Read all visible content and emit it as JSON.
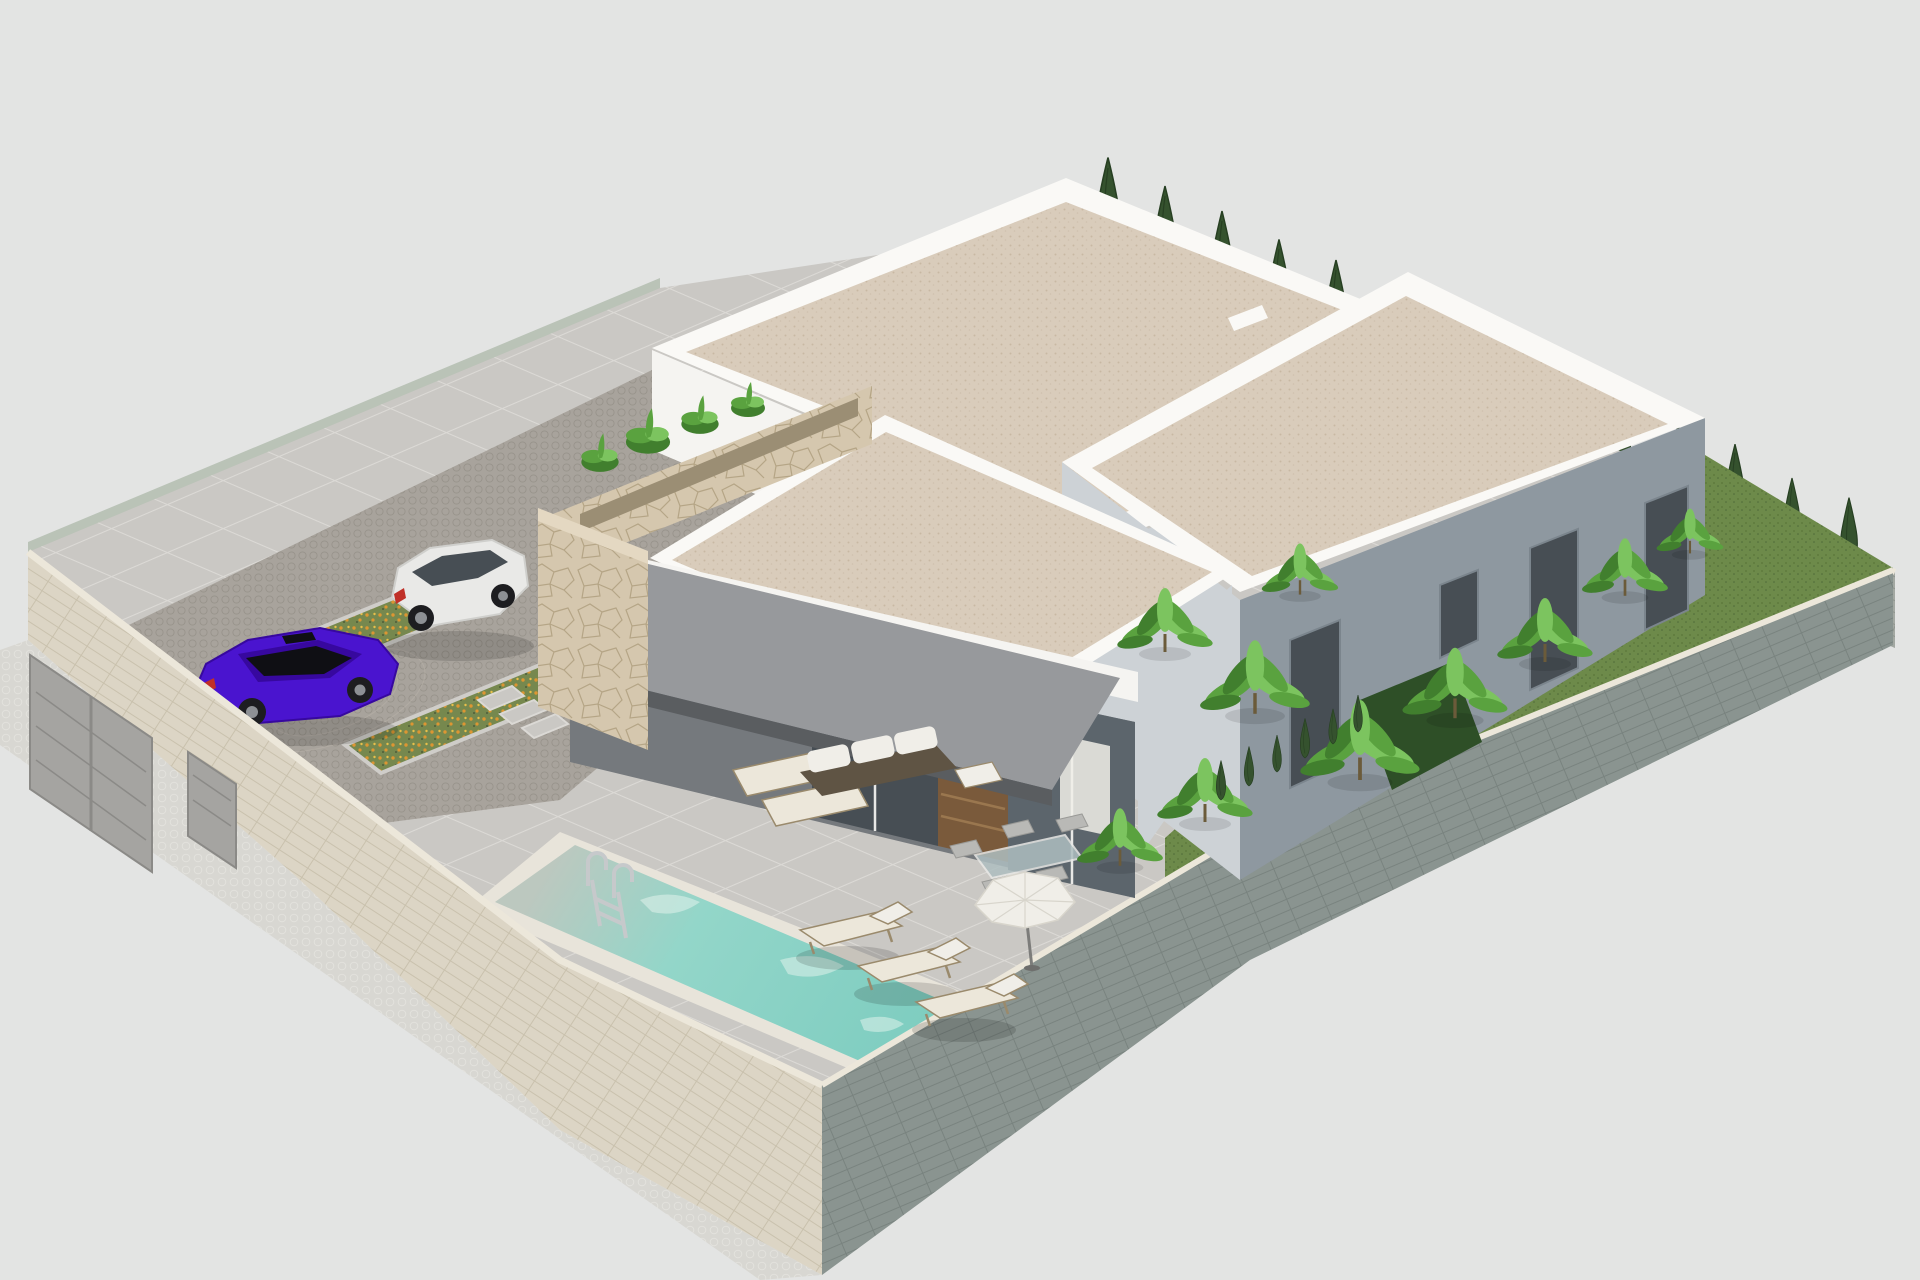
{
  "scene": {
    "width": 1920,
    "height": 1280,
    "kind": "isometric-architectural-render-villa-with-pool"
  },
  "colors": {
    "bg": "#e3e4e3",
    "sidewalk": "#d8d7d2",
    "sidewalk-dot": "#e3e2dd",
    "brick-beige": "#dcd5c5",
    "brick-beige-joint": "#c9c1ad",
    "brick-green": "#8a9490",
    "brick-green-joint": "#79837f",
    "brick-gray": "#a9a8a4",
    "brick-gray-joint": "#97958f",
    "brick-gray2": "#a3a8a2",
    "brick-gray2-joint": "#8f948e",
    "wall-cap": "#ece7da",
    "glass-band": "#b5bfb1",
    "gate": "#a5a4a1",
    "gate-dark": "#8b8a87",
    "tile": "#cac8c4",
    "tile-joint": "#dbd9d5",
    "cobble": "#a8a39c",
    "cobble-dot": "#98938b",
    "grass": "#6d8a4a",
    "grass-dot": "#597539",
    "grass-dark": "#4e6a38",
    "bed-green": "#76884e",
    "bed-dark": "#4e5c38",
    "flower-orange": "#dd9632",
    "flower-yellow": "#e8c04a",
    "curb": "#cfcdc9",
    "pool-shallow": "#bcc8bf",
    "pool-mid": "#93d6c9",
    "pool-deep": "#7cccbf",
    "coping": "#e8e4da",
    "ladder": "#c6c9cb",
    "caustic": "#e8f5ef",
    "white-lit": "#f5f4f1",
    "white-top": "#faf9f6",
    "white-shade": "#cdd2d6",
    "blue-gray": "#8e98a0",
    "blue-gray-dark": "#7b858d",
    "gravel": "#d9ccbb",
    "gravel-d1": "#c8b8a3",
    "gravel-d2": "#cfc1ae",
    "stone": "#d5c7ae",
    "stone-dark": "#9b8e74",
    "stone-line": "#b5a586",
    "stone-cap": "#e4d8c2",
    "awning": "#97999c",
    "awning-edge": "#5a5d60",
    "recess": "#75797d",
    "glass-a": "#474e54",
    "glass-b": "#5c656c",
    "mullion": "#e8e8e6",
    "door-brown": "#7a5a3b",
    "door-slat": "#9a774f",
    "cypress": "#35522e",
    "cypress-dark": "#273f22",
    "banana": "#5aa23f",
    "banana-light": "#7cc45f",
    "banana-dark": "#417f2e",
    "trunk": "#6b5b3a",
    "hedge": "#2e4f27",
    "cream": "#ece7da",
    "lounger-frame": "#9a8a6c",
    "wicker": "#5f5444",
    "cushion": "#f0eee8",
    "shadow": "rgba(0,0,0,0.14)",
    "car-purple": "#4a14cf",
    "car-purple-dark": "#37089f",
    "car-glass": "#0f0f14",
    "car-red": "#c03028",
    "car-white": "#e9e9e7",
    "car-white-shade": "#cfcfcc",
    "wheel": "#1d1d20",
    "hub": "#8d9094",
    "metal": "#b9bdc0"
  },
  "clones": {
    "back_right_cypresses": [
      {
        "x": 1108,
        "y": 250,
        "s": 1.05
      },
      {
        "x": 1165,
        "y": 274,
        "s": 1.0
      },
      {
        "x": 1222,
        "y": 299,
        "s": 1.0
      },
      {
        "x": 1279,
        "y": 323,
        "s": 0.95
      },
      {
        "x": 1336,
        "y": 348,
        "s": 1.0
      },
      {
        "x": 1393,
        "y": 372,
        "s": 0.9
      },
      {
        "x": 1450,
        "y": 397,
        "s": 0.95
      },
      {
        "x": 1507,
        "y": 421,
        "s": 0.9
      },
      {
        "x": 1564,
        "y": 446,
        "s": 0.85
      },
      {
        "x": 1621,
        "y": 470,
        "s": 0.9
      },
      {
        "x": 1678,
        "y": 495,
        "s": 0.8
      },
      {
        "x": 1735,
        "y": 519,
        "s": 0.85
      },
      {
        "x": 1792,
        "y": 544,
        "s": 0.75
      },
      {
        "x": 1849,
        "y": 568,
        "s": 0.8
      }
    ],
    "back_left_cypresses": [
      {
        "x": 723,
        "y": 452,
        "s": 1.5
      },
      {
        "x": 760,
        "y": 468,
        "s": 1.25
      }
    ],
    "inner_corner_cypresses": [
      {
        "x": 1020,
        "y": 726,
        "s": 0.6
      },
      {
        "x": 1048,
        "y": 742,
        "s": 0.55
      }
    ],
    "garden_small_cypresses": [
      {
        "x": 1221,
        "y": 800,
        "s": 0.45
      },
      {
        "x": 1249,
        "y": 786,
        "s": 0.45
      },
      {
        "x": 1277,
        "y": 772,
        "s": 0.42
      },
      {
        "x": 1305,
        "y": 758,
        "s": 0.45
      },
      {
        "x": 1333,
        "y": 744,
        "s": 0.4
      },
      {
        "x": 1358,
        "y": 732,
        "s": 0.42
      }
    ],
    "banana_clusters": [
      {
        "x": 1165,
        "y": 640,
        "s": 1.0
      },
      {
        "x": 1255,
        "y": 700,
        "s": 1.15
      },
      {
        "x": 1360,
        "y": 765,
        "s": 1.25
      },
      {
        "x": 1455,
        "y": 705,
        "s": 1.1
      },
      {
        "x": 1545,
        "y": 650,
        "s": 1.0
      },
      {
        "x": 1625,
        "y": 585,
        "s": 0.9
      },
      {
        "x": 1300,
        "y": 585,
        "s": 0.8
      },
      {
        "x": 1205,
        "y": 810,
        "s": 1.0
      },
      {
        "x": 1120,
        "y": 855,
        "s": 0.9
      },
      {
        "x": 1690,
        "y": 545,
        "s": 0.7
      }
    ],
    "pool_loungers": [
      {
        "x": 800,
        "y": 912,
        "s": 1
      },
      {
        "x": 858,
        "y": 948,
        "s": 1
      },
      {
        "x": 916,
        "y": 984,
        "s": 1
      }
    ],
    "planter_plants": [
      {
        "x": 600,
        "y": 462,
        "s": 0.55
      },
      {
        "x": 648,
        "y": 442,
        "s": 0.65
      },
      {
        "x": 700,
        "y": 424,
        "s": 0.55
      },
      {
        "x": 748,
        "y": 408,
        "s": 0.5
      }
    ]
  }
}
